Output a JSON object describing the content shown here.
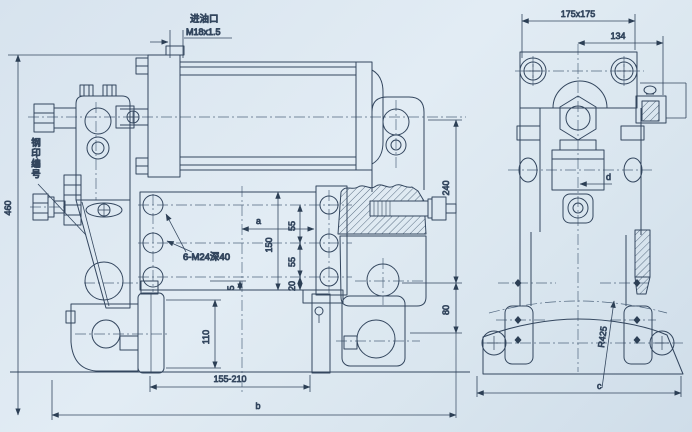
{
  "meta": {
    "background": "#dce7f0",
    "ink": "#33465e",
    "centerline_color": "#51677f"
  },
  "labels": {
    "oil_inlet": "进油口",
    "oil_inlet_thread": "M18x1.5",
    "stamp_number": "钢印编号",
    "bolt_spec": "6-M24深40"
  },
  "front_view": {
    "dim_height": "460",
    "dim_240": "240",
    "dim_80": "80",
    "dim_150": "150",
    "dim_55_upper": "55",
    "dim_55_lower": "55",
    "dim_20": "20",
    "dim_5": "5",
    "dim_a": "a",
    "dim_110": "110",
    "dim_range": "155-210",
    "dim_b": "b"
  },
  "side_view": {
    "dim_plate": "175x175",
    "dim_134": "134",
    "dim_d": "d",
    "dim_radius": "R425",
    "dim_c": "c"
  }
}
